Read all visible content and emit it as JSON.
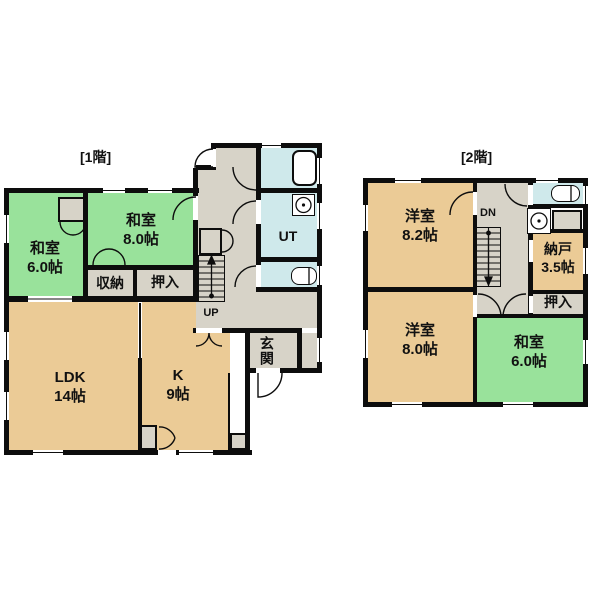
{
  "floor1": {
    "label": "[1階]",
    "rooms": {
      "washitsu6": {
        "name": "和室",
        "size": "6.0帖"
      },
      "washitsu8": {
        "name": "和室",
        "size": "8.0帖"
      },
      "shuno": {
        "name": "収納"
      },
      "oshiire": {
        "name": "押入"
      },
      "ldk": {
        "name": "LDK",
        "size": "14帖"
      },
      "kitchen": {
        "name": "K",
        "size": "9帖"
      },
      "ut": {
        "name": "UT"
      },
      "up": {
        "name": "UP"
      },
      "genkan": {
        "name": "玄関"
      }
    }
  },
  "floor2": {
    "label": "[2階]",
    "rooms": {
      "yoshitsu82": {
        "name": "洋室",
        "size": "8.2帖"
      },
      "yoshitsu80": {
        "name": "洋室",
        "size": "8.0帖"
      },
      "washitsu6": {
        "name": "和室",
        "size": "6.0帖"
      },
      "nando": {
        "name": "納戸",
        "size": "3.5帖"
      },
      "oshiire": {
        "name": "押入"
      },
      "dn": {
        "name": "DN"
      }
    }
  },
  "colors": {
    "wall": "#0d0d0d",
    "tatami_green": "#99e29b",
    "wood_tan": "#ebcb96",
    "hall_grey": "#d7d3c8",
    "wet_blue": "#cfe9eb",
    "white": "#ffffff"
  }
}
